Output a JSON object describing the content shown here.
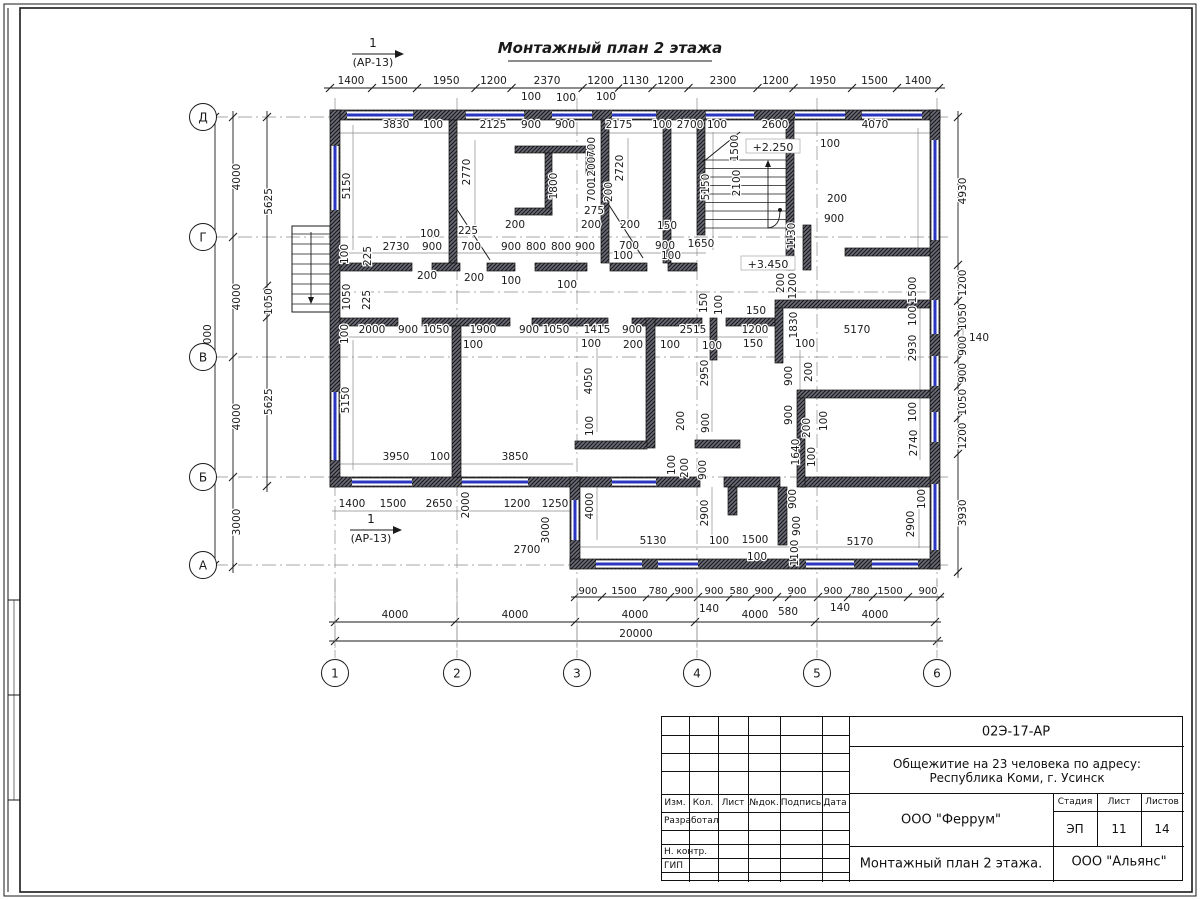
{
  "header": {
    "title": "Монтажный план 2 этажа"
  },
  "section_markers": [
    {
      "num": "1",
      "ref": "(АР-13)",
      "x": 373,
      "y": 47
    },
    {
      "num": "1",
      "ref": "(АР-13)",
      "x": 371,
      "y": 523
    }
  ],
  "level_marks": [
    {
      "t": "+2.250",
      "x": 773,
      "y": 149
    },
    {
      "t": "+3.450",
      "x": 768,
      "y": 266
    }
  ],
  "axes": {
    "cols": [
      {
        "label": "1",
        "x": 335
      },
      {
        "label": "2",
        "x": 457
      },
      {
        "label": "3",
        "x": 577
      },
      {
        "label": "4",
        "x": 697
      },
      {
        "label": "5",
        "x": 817
      },
      {
        "label": "6",
        "x": 937
      }
    ],
    "rows": [
      {
        "label": "Д",
        "y": 117
      },
      {
        "label": "Г",
        "y": 237
      },
      {
        "label": "В",
        "y": 357
      },
      {
        "label": "Б",
        "y": 477
      },
      {
        "label": "А",
        "y": 565
      }
    ]
  },
  "chains": {
    "top": {
      "y": 88,
      "x0": 330,
      "scale": 0.03,
      "values": [
        1400,
        1500,
        1950,
        1200,
        2370,
        1200,
        1130,
        1200,
        2300,
        1200,
        1950,
        1500,
        1400
      ]
    },
    "bottom_4000": {
      "y": 622,
      "x0": 335,
      "scale": 0.03,
      "values": [
        4000,
        4000,
        4000,
        4000,
        4000
      ]
    },
    "bottom_total": {
      "t": "20000",
      "y": 641,
      "x0": 335,
      "x1": 937
    },
    "left_outer": {
      "x": 233,
      "y0": 117,
      "scale": 0.03,
      "values": [
        4000,
        4000,
        4000,
        3000
      ]
    },
    "left_inner": {
      "x": 267,
      "y0": 117,
      "scale": 0.03,
      "values": [
        5625,
        1050,
        5625
      ]
    },
    "left_total": {
      "t": "15000",
      "x": 215,
      "y0": 117,
      "y1": 565
    },
    "right": {
      "x": 958,
      "y0": 117,
      "scale": 0.03,
      "values": [
        4930,
        1200,
        1050,
        900,
        900,
        1050,
        1200,
        3930
      ]
    },
    "bottom_900": {
      "y": 597,
      "labels": [
        [
          "900",
          588
        ],
        [
          "1500",
          624
        ],
        [
          "780",
          658
        ],
        [
          "900",
          684
        ],
        [
          "900",
          714
        ],
        [
          "580",
          739
        ],
        [
          "900",
          764
        ],
        [
          "900",
          797
        ],
        [
          "900",
          833
        ],
        [
          "780",
          860
        ],
        [
          "1500",
          890
        ],
        [
          "900",
          928
        ]
      ]
    }
  },
  "dim_labels": [
    [
      "100",
      531,
      100
    ],
    [
      "100",
      566,
      101
    ],
    [
      "100",
      606,
      100
    ],
    [
      "3830",
      396,
      128
    ],
    [
      "100",
      433,
      128
    ],
    [
      "2125",
      493,
      128
    ],
    [
      "900",
      531,
      128
    ],
    [
      "900",
      565,
      128
    ],
    [
      "2175",
      619,
      128
    ],
    [
      "100",
      662,
      128
    ],
    [
      "2700",
      690,
      128
    ],
    [
      "100",
      717,
      128
    ],
    [
      "2600",
      775,
      128
    ],
    [
      "4070",
      875,
      128
    ],
    [
      "5150",
      350,
      186,
      1
    ],
    [
      "2770",
      470,
      172,
      1
    ],
    [
      "1800",
      557,
      186,
      1
    ],
    [
      "2720",
      623,
      168,
      1
    ],
    [
      "700",
      595,
      147,
      1
    ],
    [
      "1200",
      595,
      170,
      1
    ],
    [
      "700",
      595,
      192,
      1
    ],
    [
      "200",
      612,
      192,
      1
    ],
    [
      "275",
      594,
      214
    ],
    [
      "5150",
      709,
      187,
      1
    ],
    [
      "1500",
      738,
      148,
      1
    ],
    [
      "2100",
      740,
      183,
      1
    ],
    [
      "100",
      830,
      147
    ],
    [
      "200",
      837,
      202
    ],
    [
      "900",
      834,
      222
    ],
    [
      "1130",
      795,
      236,
      1
    ],
    [
      "2730",
      396,
      250
    ],
    [
      "900",
      432,
      250
    ],
    [
      "700",
      471,
      250
    ],
    [
      "900",
      511,
      250
    ],
    [
      "800",
      536,
      250
    ],
    [
      "800",
      561,
      250
    ],
    [
      "900",
      585,
      250
    ],
    [
      "700",
      629,
      249
    ],
    [
      "900",
      665,
      249
    ],
    [
      "1650",
      701,
      247
    ],
    [
      "200",
      515,
      228
    ],
    [
      "200",
      591,
      228
    ],
    [
      "200",
      630,
      228
    ],
    [
      "150",
      667,
      229
    ],
    [
      "100",
      430,
      237
    ],
    [
      "225",
      468,
      234
    ],
    [
      "100",
      348,
      254,
      1
    ],
    [
      "225",
      371,
      256,
      1
    ],
    [
      "1050",
      350,
      297,
      1
    ],
    [
      "225",
      370,
      300,
      1
    ],
    [
      "200",
      427,
      279
    ],
    [
      "200",
      474,
      281
    ],
    [
      "100",
      511,
      284
    ],
    [
      "100",
      567,
      288
    ],
    [
      "100",
      623,
      259
    ],
    [
      "100",
      671,
      259
    ],
    [
      "150",
      707,
      303,
      1
    ],
    [
      "100",
      722,
      305,
      1
    ],
    [
      "1200",
      796,
      286,
      1
    ],
    [
      "200",
      784,
      283,
      1
    ],
    [
      "1830",
      797,
      325,
      1
    ],
    [
      "1500",
      916,
      290,
      1
    ],
    [
      "100",
      348,
      334,
      1
    ],
    [
      "2000",
      372,
      333
    ],
    [
      "900",
      408,
      333
    ],
    [
      "1050",
      436,
      333
    ],
    [
      "1900",
      483,
      333
    ],
    [
      "900",
      529,
      333
    ],
    [
      "1050",
      556,
      333
    ],
    [
      "100",
      473,
      348
    ],
    [
      "1415",
      597,
      333
    ],
    [
      "900",
      632,
      333
    ],
    [
      "2515",
      693,
      333
    ],
    [
      "100",
      591,
      347
    ],
    [
      "200",
      633,
      348
    ],
    [
      "100",
      670,
      348
    ],
    [
      "100",
      712,
      349
    ],
    [
      "150",
      756,
      314
    ],
    [
      "1200",
      755,
      333
    ],
    [
      "150",
      753,
      347
    ],
    [
      "5170",
      857,
      333
    ],
    [
      "100",
      805,
      347
    ],
    [
      "100",
      916,
      316,
      1
    ],
    [
      "2930",
      916,
      348,
      1
    ],
    [
      "5150",
      349,
      400,
      1
    ],
    [
      "4050",
      592,
      381,
      1
    ],
    [
      "100",
      593,
      426,
      1
    ],
    [
      "2950",
      708,
      373,
      1
    ],
    [
      "900",
      709,
      423,
      1
    ],
    [
      "200",
      684,
      421,
      1
    ],
    [
      "100",
      675,
      465,
      1
    ],
    [
      "200",
      688,
      468,
      1
    ],
    [
      "900",
      706,
      470,
      1
    ],
    [
      "900",
      792,
      376,
      1
    ],
    [
      "200",
      812,
      372,
      1
    ],
    [
      "900",
      792,
      415,
      1
    ],
    [
      "200",
      810,
      428,
      1
    ],
    [
      "100",
      827,
      421,
      1
    ],
    [
      "1640",
      799,
      452,
      1
    ],
    [
      "100",
      815,
      457,
      1
    ],
    [
      "2740",
      917,
      443,
      1
    ],
    [
      "100",
      916,
      412,
      1
    ],
    [
      "3950",
      396,
      460
    ],
    [
      "100",
      440,
      460
    ],
    [
      "3850",
      515,
      460
    ],
    [
      "1400",
      352,
      507
    ],
    [
      "1500",
      393,
      507
    ],
    [
      "2650",
      439,
      507
    ],
    [
      "1200",
      517,
      507
    ],
    [
      "1250",
      555,
      507
    ],
    [
      "2000",
      469,
      505,
      1
    ],
    [
      "3000",
      549,
      530,
      1
    ],
    [
      "2700",
      527,
      553
    ],
    [
      "4000",
      593,
      506,
      1
    ],
    [
      "2900",
      708,
      513,
      1
    ],
    [
      "5130",
      653,
      544
    ],
    [
      "100",
      719,
      544
    ],
    [
      "1500",
      755,
      543
    ],
    [
      "100",
      757,
      560
    ],
    [
      "900",
      796,
      499,
      1
    ],
    [
      "900",
      800,
      526,
      1
    ],
    [
      "1100",
      798,
      553,
      1
    ],
    [
      "5170",
      860,
      545
    ],
    [
      "100",
      925,
      499,
      1
    ],
    [
      "2900",
      914,
      524,
      1
    ],
    [
      "140",
      709,
      612
    ],
    [
      "580",
      788,
      615
    ],
    [
      "140",
      840,
      611
    ],
    [
      "140",
      979,
      341
    ]
  ],
  "title_block": {
    "doc_number": "02Э-17-АР",
    "project_line1": "Общежитие на 23 человека по адресу:",
    "project_line2": "Республика Коми, г. Усинск",
    "cols": [
      "Изм.",
      "Кол.",
      "Лист",
      "№док.",
      "Подпись",
      "Дата"
    ],
    "developed_label": "Разработал",
    "ncontrol_label": "Н. контр.",
    "gip_label": "ГИП",
    "designer": "ООО \"Феррум\"",
    "stage_label": "Стадия",
    "stage": "ЭП",
    "sheet_label": "Лист",
    "sheet": "11",
    "sheets_label": "Листов",
    "sheets": "14",
    "drawing_name": "Монтажный план 2 этажа.",
    "contractor": "ООО \"Альянс\""
  },
  "colors": {
    "ink": "#1a1a1a",
    "window_blue": "#2a35c0",
    "guide": "#8a8a8a"
  }
}
